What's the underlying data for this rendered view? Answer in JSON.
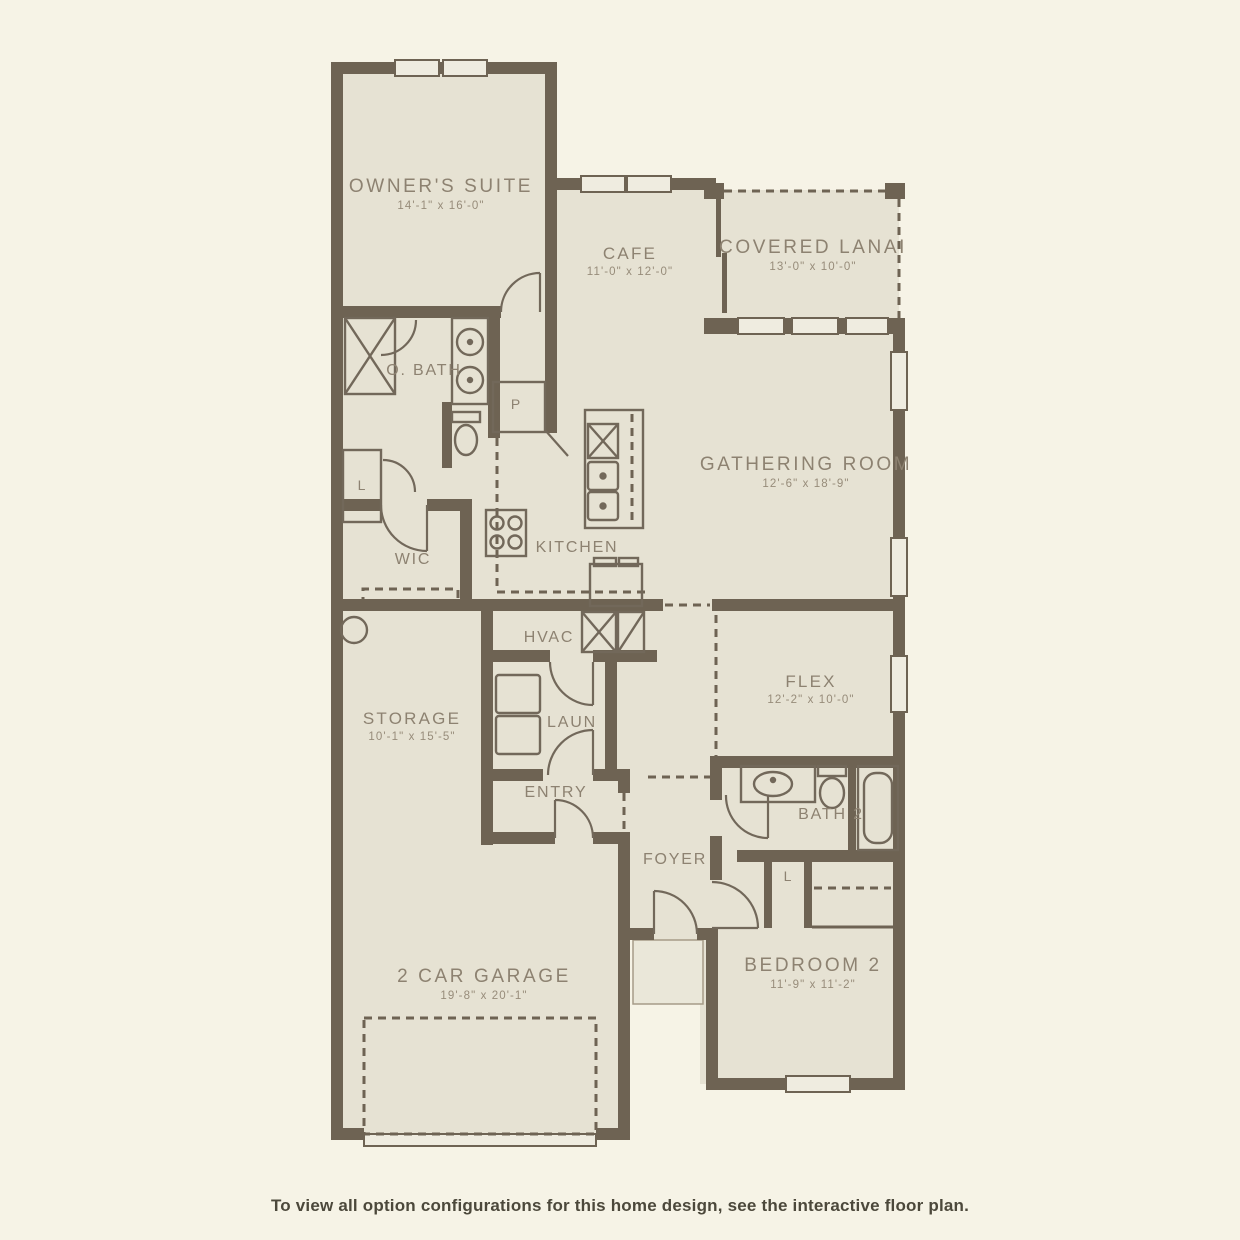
{
  "page": {
    "caption": "To view all option configurations for this home design, see the interactive floor plan."
  },
  "palette": {
    "background": "#f6f3e6",
    "room_fill": "#e6e2d3",
    "wall": "#6e6353",
    "fixture_stroke": "#72685a",
    "window_fill": "#efece0",
    "label_text": "#8d8271",
    "caption_text": "#4c483b"
  },
  "rooms": {
    "owners_suite": {
      "name": "OWNER'S SUITE",
      "dims": "14'-1\" x 16'-0\""
    },
    "cafe": {
      "name": "CAFE",
      "dims": "11'-0\" x 12'-0\""
    },
    "covered_lanai": {
      "name": "COVERED LANAI",
      "dims": "13'-0\" x 10'-0\""
    },
    "o_bath": {
      "name": "O. BATH"
    },
    "gathering_room": {
      "name": "GATHERING ROOM",
      "dims": "12'-6\" x 18'-9\""
    },
    "wic": {
      "name": "WIC"
    },
    "kitchen": {
      "name": "KITCHEN"
    },
    "hvac": {
      "name": "HVAC"
    },
    "storage": {
      "name": "STORAGE",
      "dims": "10'-1\" x 15'-5\""
    },
    "laundry": {
      "name": "LAUN"
    },
    "entry": {
      "name": "ENTRY"
    },
    "flex": {
      "name": "FLEX",
      "dims": "12'-2\" x 10'-0\""
    },
    "foyer": {
      "name": "FOYER"
    },
    "bath_2": {
      "name": "BATH 2"
    },
    "bedroom_2": {
      "name": "BEDROOM 2",
      "dims": "11'-9\" x 11'-2\""
    },
    "garage": {
      "name": "2 CAR GARAGE",
      "dims": "19'-8\" x 20'-1\""
    }
  },
  "closets": {
    "pantry": "P",
    "linen_obath": "L",
    "linen_bath2": "L"
  }
}
